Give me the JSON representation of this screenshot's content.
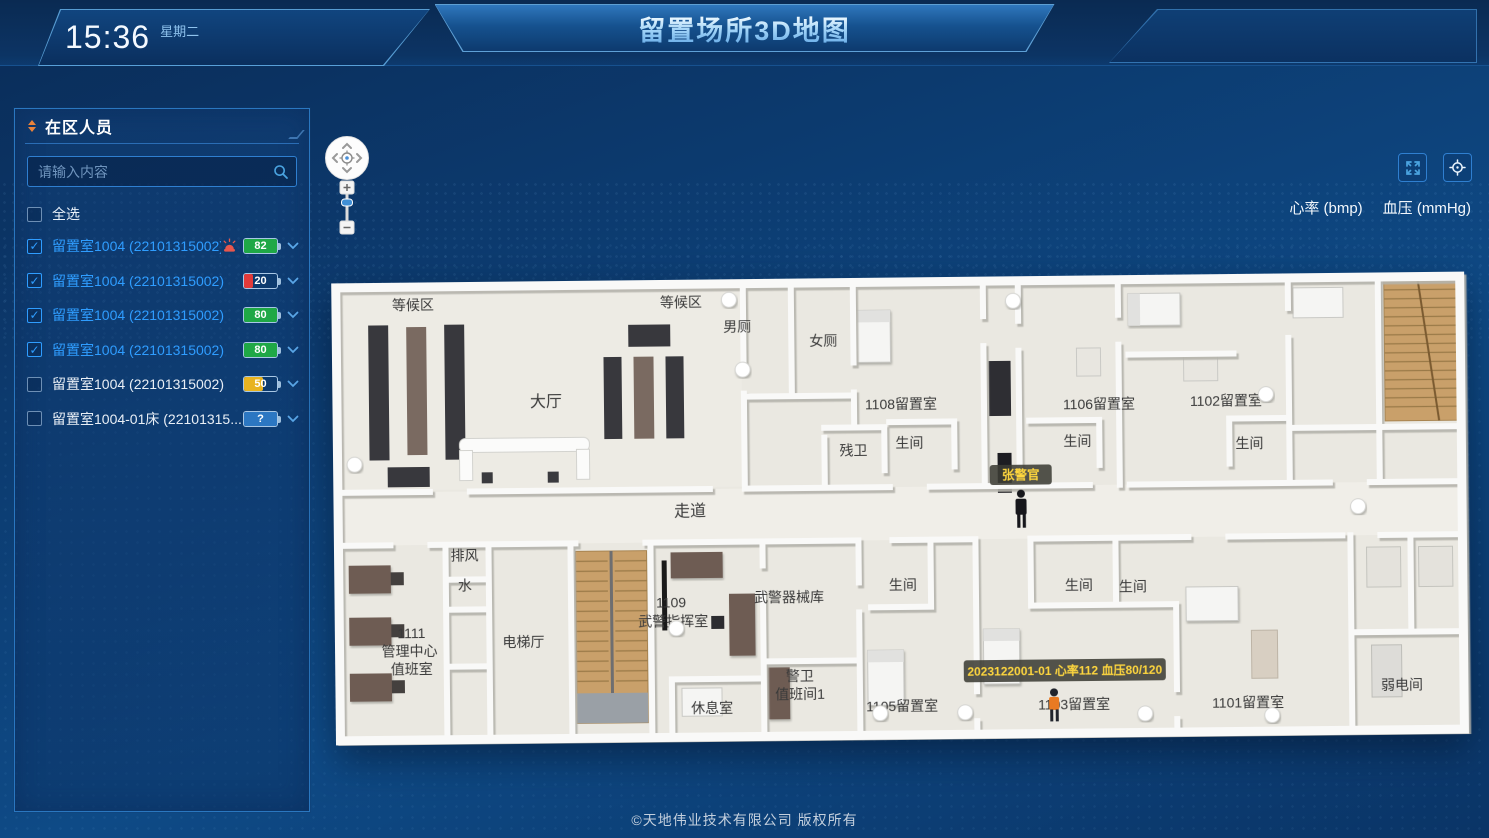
{
  "header": {
    "time": "15:36",
    "weekday": "星期二",
    "title": "留置场所3D地图"
  },
  "sidebar": {
    "title": "在区人员",
    "search_placeholder": "请输入内容",
    "select_all": "全选",
    "items": [
      {
        "label": "留置室1004 (22101315002)",
        "checked": true,
        "alarm": true,
        "value": "82",
        "color": "#1fa846",
        "pct": 100
      },
      {
        "label": "留置室1004 (22101315002)",
        "checked": true,
        "alarm": false,
        "value": "20",
        "color": "#e23a3a",
        "pct": 26
      },
      {
        "label": "留置室1004 (22101315002)",
        "checked": true,
        "alarm": false,
        "value": "80",
        "color": "#1fa846",
        "pct": 100
      },
      {
        "label": "留置室1004 (22101315002)",
        "checked": true,
        "alarm": false,
        "value": "80",
        "color": "#1fa846",
        "pct": 100
      },
      {
        "label": "留置室1004 (22101315002)",
        "checked": false,
        "alarm": false,
        "value": "50",
        "color": "#e8b320",
        "pct": 58
      },
      {
        "label": "留置室1004-01床 (22101315...",
        "checked": false,
        "alarm": false,
        "value": "?",
        "color": "#2c77c2",
        "pct": 100
      }
    ]
  },
  "toolbar": {
    "hr_label": "心率 (bmp)",
    "bp_label": "血压 (mmHg)"
  },
  "map": {
    "officer_tag": "张警官",
    "tooltip": "2023122001-01  心率112  血压80/120",
    "labels": [
      {
        "text": "等候区",
        "x": 85,
        "y": 43
      },
      {
        "text": "等候区",
        "x": 353,
        "y": 43
      },
      {
        "text": "男厕",
        "x": 409,
        "y": 68
      },
      {
        "text": "女厕",
        "x": 495,
        "y": 83
      },
      {
        "text": "大厅",
        "x": 217,
        "y": 141,
        "fs": 16
      },
      {
        "text": "1108留置室",
        "x": 572,
        "y": 147
      },
      {
        "text": "1106留置室",
        "x": 770,
        "y": 149
      },
      {
        "text": "1102留置室",
        "x": 897,
        "y": 147
      },
      {
        "text": "残卫",
        "x": 524,
        "y": 193
      },
      {
        "text": "生间",
        "x": 580,
        "y": 186
      },
      {
        "text": "生间",
        "x": 748,
        "y": 186
      },
      {
        "text": "生间",
        "x": 920,
        "y": 190
      },
      {
        "text": "走道",
        "x": 360,
        "y": 252,
        "fs": 16
      },
      {
        "text": "排风",
        "x": 134,
        "y": 294
      },
      {
        "text": "水",
        "x": 134,
        "y": 324
      },
      {
        "text": "1111",
        "x": 80,
        "y": 371
      },
      {
        "text": "管理中心",
        "x": 78,
        "y": 389
      },
      {
        "text": "值班室",
        "x": 80,
        "y": 407
      },
      {
        "text": "电梯厅",
        "x": 192,
        "y": 381
      },
      {
        "text": "1109",
        "x": 340,
        "y": 343
      },
      {
        "text": "武警指挥室",
        "x": 342,
        "y": 362
      },
      {
        "text": "武警器械库",
        "x": 458,
        "y": 339
      },
      {
        "text": "警卫",
        "x": 468,
        "y": 418
      },
      {
        "text": "值班间1",
        "x": 468,
        "y": 436
      },
      {
        "text": "休息室",
        "x": 380,
        "y": 449
      },
      {
        "text": "生间",
        "x": 572,
        "y": 328
      },
      {
        "text": "生间",
        "x": 748,
        "y": 330
      },
      {
        "text": "生间",
        "x": 802,
        "y": 332
      },
      {
        "text": "1105留置室",
        "x": 570,
        "y": 449
      },
      {
        "text": "1103留置室",
        "x": 742,
        "y": 449
      },
      {
        "text": "1101留置室",
        "x": 916,
        "y": 449
      },
      {
        "text": "弱电间",
        "x": 1070,
        "y": 433
      }
    ],
    "markers": [
      [
        25,
        197
      ],
      [
        401,
        36
      ],
      [
        414,
        106
      ],
      [
        685,
        40
      ],
      [
        937,
        136
      ],
      [
        1028,
        249
      ],
      [
        345,
        364
      ],
      [
        548,
        451
      ],
      [
        633,
        451
      ],
      [
        813,
        454
      ],
      [
        940,
        457
      ]
    ]
  },
  "footer": {
    "copyright": "©天地伟业技术有限公司 版权所有"
  }
}
